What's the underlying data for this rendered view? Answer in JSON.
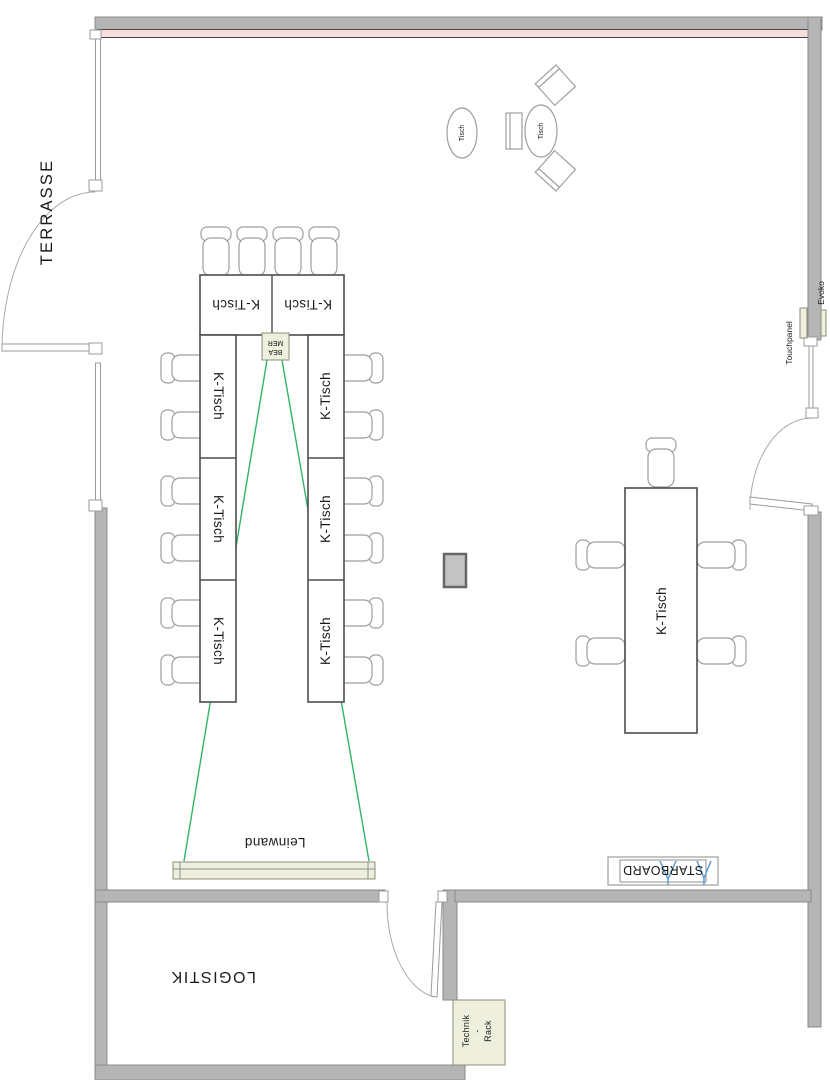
{
  "labels": {
    "terrace": "TERRASSE",
    "logistics": "LOGISTIK",
    "screen": "Leinwand",
    "beamer_line1": "BEA",
    "beamer_line2": "MER",
    "starboard": "STARBOARD",
    "technik_line1": "Technik",
    "technik_line2": "-",
    "technik_line3": "Rack",
    "touchpanel": "Touchpanel",
    "evoko": "Evoko",
    "conference_table": "K-Tisch",
    "round_table": "Tisch"
  },
  "colors": {
    "wall": "#b5b5b5",
    "wall_stroke": "#8a8a8a",
    "heater": "#f6dede",
    "beige": "#eeefdd",
    "beam_green": "#2fb566",
    "starboard_blue": "#5b9bd5",
    "text": "#1a1a1a"
  }
}
